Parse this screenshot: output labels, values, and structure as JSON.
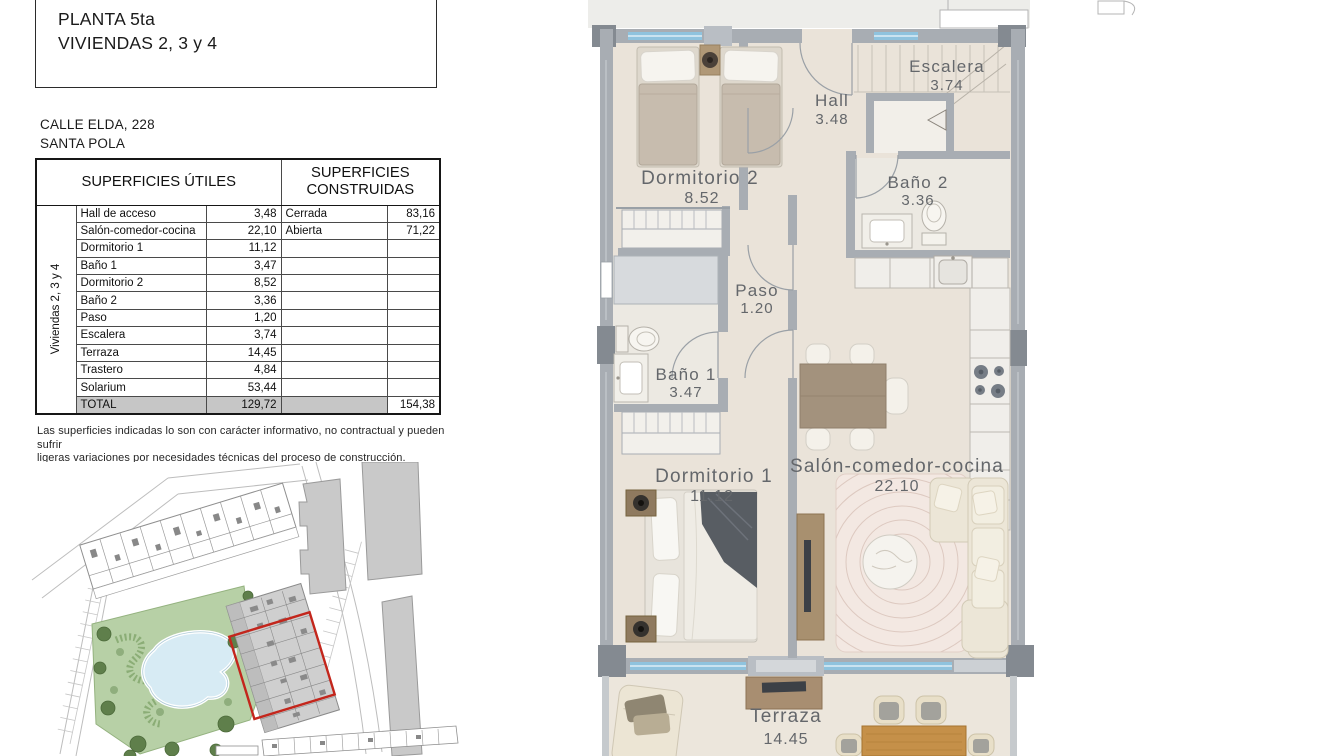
{
  "title_box": {
    "line1": "PLANTA 5ta",
    "line2": "VIVIENDAS 2, 3 y 4"
  },
  "address": {
    "line1": "CALLE ELDA, 228",
    "line2": "SANTA POLA"
  },
  "areas_table": {
    "header_utiles": "SUPERFICIES ÚTILES",
    "header_construidas": "SUPERFICIES CONSTRUIDAS",
    "group_label": "Viviendas 2, 3 y 4",
    "rows": [
      {
        "label": "Hall de acceso",
        "value": "3,48",
        "c_label": "Cerrada",
        "c_value": "83,16"
      },
      {
        "label": "Salón-comedor-cocina",
        "value": "22,10",
        "c_label": "Abierta",
        "c_value": "71,22"
      },
      {
        "label": "Dormitorio 1",
        "value": "11,12",
        "c_label": "",
        "c_value": ""
      },
      {
        "label": "Baño 1",
        "value": "3,47",
        "c_label": "",
        "c_value": ""
      },
      {
        "label": "Dormitorio 2",
        "value": "8,52",
        "c_label": "",
        "c_value": ""
      },
      {
        "label": "Baño 2",
        "value": "3,36",
        "c_label": "",
        "c_value": ""
      },
      {
        "label": "Paso",
        "value": "1,20",
        "c_label": "",
        "c_value": ""
      },
      {
        "label": "Escalera",
        "value": "3,74",
        "c_label": "",
        "c_value": ""
      },
      {
        "label": "Terraza",
        "value": "14,45",
        "c_label": "",
        "c_value": ""
      },
      {
        "label": "Trastero",
        "value": "4,84",
        "c_label": "",
        "c_value": ""
      },
      {
        "label": "Solarium",
        "value": "53,44",
        "c_label": "",
        "c_value": ""
      }
    ],
    "total": {
      "label": "TOTAL",
      "value": "129,72",
      "c_label": "",
      "c_value": "154,38"
    }
  },
  "disclaimer": {
    "line1": "Las superficies indicadas lo son con carácter informativo, no contractual y pueden sufrir",
    "line2": "ligeras variaciones por necesidades técnicas del proceso de construcción."
  },
  "floor_plan": {
    "rooms": {
      "dormitorio2": {
        "name": "Dormitorio 2",
        "area": "8.52"
      },
      "hall": {
        "name": "Hall",
        "area": "3.48"
      },
      "escalera": {
        "name": "Escalera",
        "area": "3.74"
      },
      "bano2": {
        "name": "Baño 2",
        "area": "3.36"
      },
      "paso": {
        "name": "Paso",
        "area": "1.20"
      },
      "bano1": {
        "name": "Baño 1",
        "area": "3.47"
      },
      "dormitorio1": {
        "name": "Dormitorio 1",
        "area": "11.12"
      },
      "salon": {
        "name": "Salón-comedor-cocina",
        "area": "22.10"
      },
      "terraza": {
        "name": "Terraza",
        "area": "14.45"
      }
    }
  },
  "colors": {
    "wall_gray": "#a8adb3",
    "wall_dark": "#848a91",
    "floor_beige": "#eae3d9",
    "window_blue": "#8fc3de",
    "table_total_gray": "#c6c6c6",
    "site_highlight_red": "#c3261c",
    "park_green": "#b7d0a6",
    "pool_blue": "#d7ebf4"
  }
}
